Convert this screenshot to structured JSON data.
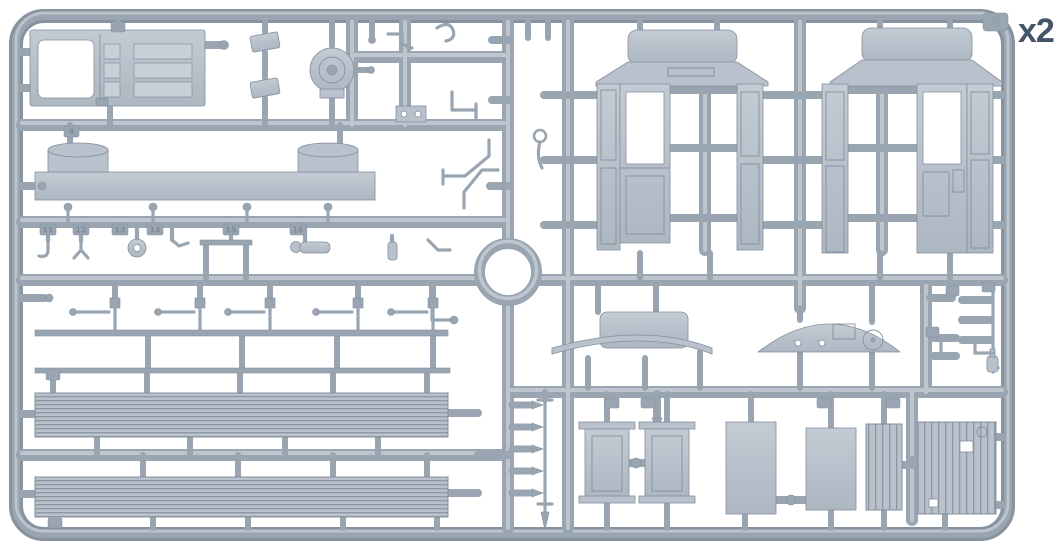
{
  "sprue": {
    "quantity_label": "x2",
    "letter": "B",
    "part_tags": [
      "9",
      "11",
      "12",
      "13",
      "14",
      "15",
      "16"
    ]
  },
  "theme": {
    "background": "#ffffff",
    "plastic": "#9aa5b2",
    "plastic_dark": "#87929f",
    "plastic_light": "#b8c1cc",
    "plastic_lighter": "#c9d0d8",
    "outline": "#84909e",
    "label": "#44546a",
    "tag_text": "#7f8b99"
  }
}
